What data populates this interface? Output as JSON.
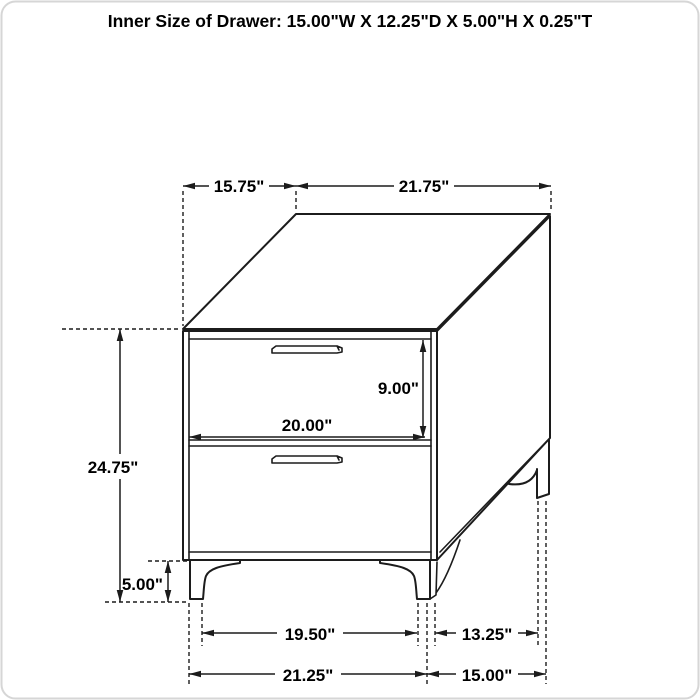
{
  "title": "Inner Size of Drawer: 15.00\"W X 12.25\"D X 5.00\"H X 0.25\"T",
  "drawing": "nightstand-dimension-diagram",
  "units": "inches",
  "dims": {
    "top_depth": "15.75\"",
    "top_width": "21.75\"",
    "overall_height": "24.75\"",
    "drawer_front_height": "9.00\"",
    "drawer_front_width": "20.00\"",
    "leg_height": "5.00\"",
    "front_leg_span": "19.50\"",
    "side_leg_span": "13.25\"",
    "base_width": "21.25\"",
    "base_depth": "15.00\""
  },
  "colors": {
    "line": "#1c1c1c",
    "background": "#ffffff",
    "text": "#000000"
  }
}
